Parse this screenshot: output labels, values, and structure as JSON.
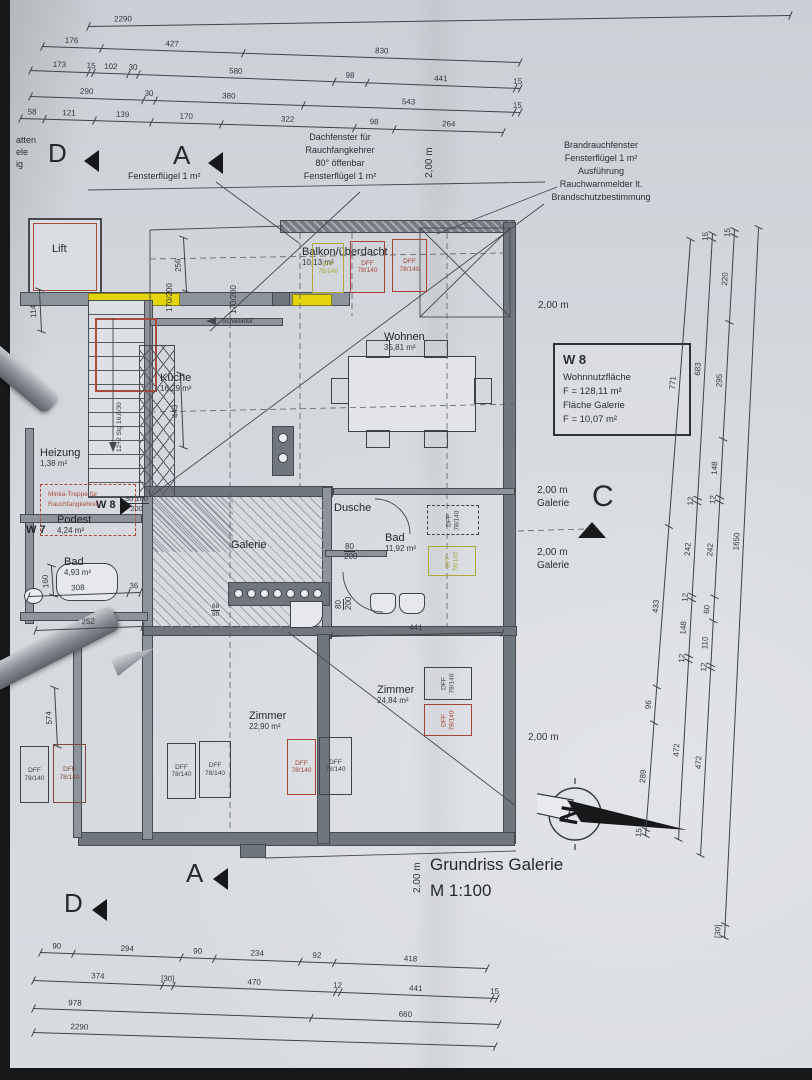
{
  "title_block": {
    "line1": "Grundriss Galerie",
    "line2": "M 1:100"
  },
  "info_box": {
    "unit": "W 8",
    "rows": [
      "Wohnnutzfläche",
      "F = 128,11 m²",
      "Fläche Galerie",
      "F = 10,07 m²"
    ]
  },
  "colors": {
    "paper": "#d4d8dd",
    "ink": "#3e434a",
    "red": "#a34438",
    "darkred": "#7d4a40",
    "yellow_box": "#a9a93e",
    "highlight_yellow": "#e3d40c",
    "marker_black": "#17181a"
  },
  "rooms": [
    {
      "name": "Lift",
      "area": "",
      "x": 52,
      "y": 243
    },
    {
      "name": "Balkon/überdacht",
      "area": "10,13 m²",
      "x": 302,
      "y": 246
    },
    {
      "name": "Küche",
      "area": "16,29 m²",
      "x": 160,
      "y": 372
    },
    {
      "name": "Wohnen",
      "area": "35,81 m²",
      "x": 384,
      "y": 331
    },
    {
      "name": "Heizung",
      "area": "1,38 m²",
      "x": 40,
      "y": 447
    },
    {
      "name": "Podest",
      "area": "4,24 m²",
      "x": 57,
      "y": 514
    },
    {
      "name": "Bad",
      "area": "4,93 m²",
      "x": 64,
      "y": 556
    },
    {
      "name": "Galerie",
      "area": "",
      "x": 231,
      "y": 539
    },
    {
      "name": "Dusche",
      "area": "",
      "x": 334,
      "y": 502
    },
    {
      "name": "Bad",
      "area": "11,92 m²",
      "x": 385,
      "y": 532
    },
    {
      "name": "Zimmer",
      "area": "22,90 m²",
      "x": 249,
      "y": 710
    },
    {
      "name": "Zimmer",
      "area": "24,84 m²",
      "x": 377,
      "y": 684
    }
  ],
  "unit_labels": [
    {
      "t": "W 8",
      "x": 96,
      "y": 499,
      "bold": true
    },
    {
      "t": "W 7",
      "x": 26,
      "y": 524,
      "bold": true
    }
  ],
  "chains": [
    {
      "x1": 88,
      "y1": 26,
      "x2": 790,
      "y2": 15,
      "segs": [
        [
          2290,
          "2290",
          0.05
        ]
      ]
    },
    {
      "x1": 42,
      "y1": 46,
      "x2": 520,
      "y2": 62,
      "segs": [
        [
          176,
          "176"
        ],
        [
          427,
          "427"
        ],
        [
          830,
          "830"
        ]
      ]
    },
    {
      "x1": 30,
      "y1": 70,
      "x2": 520,
      "y2": 88,
      "segs": [
        [
          173,
          "173"
        ],
        [
          15,
          "15"
        ],
        [
          102,
          "102"
        ],
        [
          30,
          "30"
        ],
        [
          580,
          "580"
        ],
        [
          98,
          "98"
        ],
        [
          441,
          "441"
        ],
        [
          15,
          "15"
        ]
      ]
    },
    {
      "x1": 30,
      "y1": 96,
      "x2": 520,
      "y2": 112,
      "segs": [
        [
          290,
          "290"
        ],
        [
          30,
          "30"
        ],
        [
          380,
          "380"
        ],
        [
          543,
          "543"
        ],
        [
          15,
          "15"
        ]
      ]
    },
    {
      "x1": 20,
      "y1": 118,
      "x2": 503,
      "y2": 132,
      "segs": [
        [
          58,
          "58"
        ],
        [
          121,
          "121"
        ],
        [
          139,
          "139"
        ],
        [
          170,
          "170"
        ],
        [
          322,
          "322"
        ],
        [
          98,
          "98"
        ],
        [
          264,
          "264"
        ]
      ]
    },
    {
      "x1": 40,
      "y1": 952,
      "x2": 487,
      "y2": 968,
      "segs": [
        [
          90,
          "90"
        ],
        [
          294,
          "294"
        ],
        [
          90,
          "90"
        ],
        [
          234,
          "234"
        ],
        [
          92,
          "92"
        ],
        [
          418,
          "418"
        ]
      ]
    },
    {
      "x1": 33,
      "y1": 980,
      "x2": 497,
      "y2": 998,
      "segs": [
        [
          374,
          "374"
        ],
        [
          30,
          "[30]"
        ],
        [
          470,
          "470"
        ],
        [
          12,
          "12"
        ],
        [
          441,
          "441"
        ],
        [
          15,
          "15"
        ]
      ]
    },
    {
      "x1": 33,
      "y1": 1008,
      "x2": 499,
      "y2": 1024,
      "segs": [
        [
          978,
          "978",
          0.15
        ],
        [
          660,
          "660"
        ]
      ]
    },
    {
      "x1": 33,
      "y1": 1032,
      "x2": 495,
      "y2": 1046,
      "segs": [
        [
          2290,
          "2290",
          0.1
        ]
      ]
    },
    {
      "x1": 645,
      "y1": 836,
      "x2": 690,
      "y2": 240,
      "segs": [
        [
          15,
          "15"
        ],
        [
          289,
          "289"
        ],
        [
          96,
          "96"
        ],
        [
          433,
          "433"
        ],
        [
          771,
          "771"
        ]
      ]
    },
    {
      "x1": 678,
      "y1": 840,
      "x2": 712,
      "y2": 234,
      "segs": [
        [
          472,
          "472"
        ],
        [
          12,
          "12"
        ],
        [
          148,
          "148"
        ],
        [
          12,
          "12"
        ],
        [
          242,
          "242"
        ],
        [
          12,
          "12"
        ],
        [
          683,
          "683"
        ],
        [
          15,
          "15"
        ]
      ]
    },
    {
      "x1": 700,
      "y1": 856,
      "x2": 734,
      "y2": 230,
      "segs": [
        [
          472,
          "472"
        ],
        [
          12,
          "12"
        ],
        [
          110,
          "110"
        ],
        [
          60,
          "60"
        ],
        [
          242,
          "242"
        ],
        [
          12,
          "12"
        ],
        [
          148,
          "148"
        ],
        [
          295,
          "295"
        ],
        [
          220,
          "220"
        ],
        [
          15,
          "15"
        ]
      ]
    },
    {
      "x1": 724,
      "y1": 938,
      "x2": 758,
      "y2": 228,
      "segs": [
        [
          30,
          "[30]"
        ],
        [
          1650,
          "1650",
          0.55
        ]
      ]
    },
    {
      "x1": 28,
      "y1": 596,
      "x2": 140,
      "y2": 592,
      "segs": [
        [
          308,
          "308"
        ],
        [
          36,
          "36"
        ]
      ]
    },
    {
      "x1": 35,
      "y1": 630,
      "x2": 142,
      "y2": 626,
      "segs": [
        [
          252,
          "252"
        ]
      ]
    },
    {
      "x1": 330,
      "y1": 636,
      "x2": 502,
      "y2": 632,
      "segs": [
        [
          441,
          "441"
        ]
      ]
    },
    {
      "x1": 186,
      "y1": 292,
      "x2": 183,
      "y2": 238,
      "segs": [
        [
          256,
          "256"
        ]
      ]
    },
    {
      "x1": 183,
      "y1": 448,
      "x2": 180,
      "y2": 374,
      "segs": [
        [
          443,
          "443"
        ]
      ]
    },
    {
      "x1": 41,
      "y1": 332,
      "x2": 39,
      "y2": 290,
      "segs": [
        [
          114,
          "114"
        ]
      ]
    },
    {
      "x1": 57,
      "y1": 747,
      "x2": 54,
      "y2": 688,
      "segs": [
        [
          574,
          "574"
        ]
      ]
    },
    {
      "x1": 53,
      "y1": 596,
      "x2": 51,
      "y2": 566,
      "segs": [
        [
          160,
          "160"
        ]
      ]
    }
  ],
  "dff_boxes": [
    {
      "x": 312,
      "y": 243,
      "w": 32,
      "h": 50,
      "c": "y",
      "v": false
    },
    {
      "x": 350,
      "y": 241,
      "w": 35,
      "h": 52,
      "c": "r",
      "v": false
    },
    {
      "x": 392,
      "y": 239,
      "w": 35,
      "h": 53,
      "c": "r",
      "v": false
    },
    {
      "x": 427,
      "y": 505,
      "w": 52,
      "h": 30,
      "c": "k",
      "v": true,
      "dash": true
    },
    {
      "x": 428,
      "y": 546,
      "w": 48,
      "h": 30,
      "c": "y",
      "v": true
    },
    {
      "x": 424,
      "y": 667,
      "w": 48,
      "h": 33,
      "c": "k",
      "v": true
    },
    {
      "x": 424,
      "y": 704,
      "w": 48,
      "h": 32,
      "c": "r",
      "v": true
    },
    {
      "x": 20,
      "y": 746,
      "w": 29,
      "h": 57,
      "c": "k",
      "v": false
    },
    {
      "x": 53,
      "y": 744,
      "w": 33,
      "h": 59,
      "c": "d",
      "v": false
    },
    {
      "x": 167,
      "y": 743,
      "w": 29,
      "h": 56,
      "c": "k",
      "v": false
    },
    {
      "x": 199,
      "y": 741,
      "w": 32,
      "h": 57,
      "c": "k",
      "v": false
    },
    {
      "x": 287,
      "y": 739,
      "w": 29,
      "h": 56,
      "c": "r",
      "v": false
    },
    {
      "x": 319,
      "y": 737,
      "w": 33,
      "h": 58,
      "c": "k",
      "v": false
    }
  ],
  "dff_label": {
    "l1": "DFF",
    "l2": "78/140"
  },
  "dims": [
    {
      "t": "170/200",
      "x": 165,
      "y": 312,
      "r": 1
    },
    {
      "t": "170/200",
      "x": 229,
      "y": 314,
      "r": 1
    },
    {
      "t": "12+2 Stg  16,8/30",
      "x": 116,
      "y": 452,
      "r": 1,
      "s": 6.5
    },
    {
      "t": "80",
      "b": "200",
      "x": 344,
      "y": 542
    },
    {
      "t": "80",
      "b": "200",
      "x": 334,
      "y": 610,
      "r": 1
    },
    {
      "t": "68",
      "b": "80",
      "x": 211,
      "y": 603,
      "s": 6.5
    },
    {
      "t": "30  100",
      "b": "200",
      "x": 124,
      "y": 494,
      "s": 7.5
    },
    {
      "t": "2,00 m",
      "x": 538,
      "y": 300,
      "s": 10
    },
    {
      "t": "2,00 m",
      "x": 528,
      "y": 732,
      "s": 10
    },
    {
      "t": "2,00 m",
      "x": 424,
      "y": 178,
      "r": 1,
      "s": 10
    },
    {
      "t": "2,00 m",
      "x": 412,
      "y": 893,
      "r": 1,
      "s": 10
    }
  ],
  "annotations": [
    {
      "x": 340,
      "y": 131,
      "align": "center",
      "lines": [
        "Dachfenster für",
        "Rauchfangkehrer",
        "80° öffenbar",
        "Fensterflügel 1 m²"
      ]
    },
    {
      "x": 128,
      "y": 170,
      "align": "left",
      "lines": [
        "Fensterflügel 1 m²"
      ]
    },
    {
      "x": 601,
      "y": 139,
      "align": "center",
      "lines": [
        "Brandrauchfenster",
        "Fensterflügel 1 m²",
        "Ausführung",
        "Rauchwarnmelder lt.",
        "Brandschutzbestimmung"
      ]
    },
    {
      "x": 222,
      "y": 317,
      "align": "left",
      "size": 6.5,
      "lines": [
        "Schiebetür"
      ]
    },
    {
      "x": 48,
      "y": 490,
      "align": "left",
      "size": 6.5,
      "color": "#ac4a3c",
      "lines": [
        "Minka-Treppe für",
        "Rauchfangkehrer"
      ]
    },
    {
      "x": 537,
      "y": 484,
      "align": "left",
      "size": 10,
      "lines": [
        "2,00 m",
        "Galerie"
      ]
    },
    {
      "x": 537,
      "y": 546,
      "align": "left",
      "size": 10,
      "lines": [
        "2,00 m",
        "Galerie"
      ]
    },
    {
      "x": 16,
      "y": 134,
      "align": "left",
      "size": 9,
      "lines": [
        "atten",
        "ele",
        "ig"
      ]
    }
  ],
  "markers": [
    {
      "t": "D",
      "x": 48,
      "y": 138,
      "tx": 84,
      "ty": 150,
      "dir": "left"
    },
    {
      "t": "A",
      "x": 173,
      "y": 140,
      "tx": 208,
      "ty": 152,
      "dir": "left"
    },
    {
      "t": "A",
      "x": 186,
      "y": 858,
      "tx": 213,
      "ty": 868,
      "dir": "left"
    },
    {
      "t": "D",
      "x": 64,
      "y": 888,
      "tx": 92,
      "ty": 899,
      "dir": "left"
    },
    {
      "t": "C",
      "x": 592,
      "y": 480,
      "tx": 578,
      "ty": 522,
      "dir": "up",
      "s": 30
    }
  ],
  "compass": {
    "letter": "N",
    "x": 575,
    "y": 812
  },
  "entry": {
    "arrow_x": 120,
    "arrow_y": 497
  }
}
